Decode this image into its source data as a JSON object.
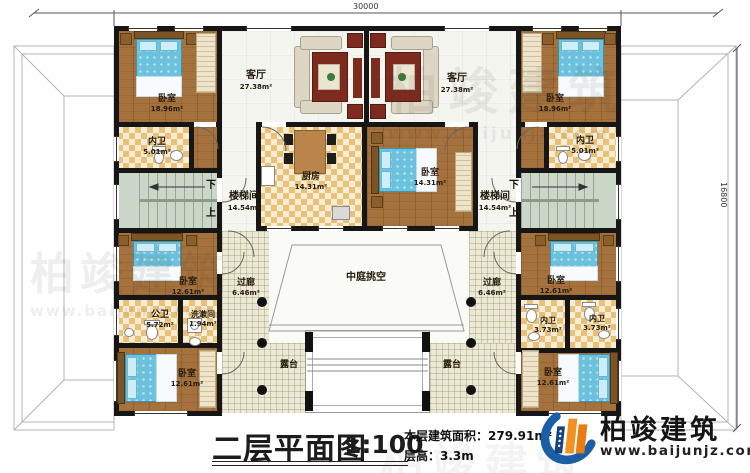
{
  "dimensions": {
    "top": "30000",
    "right": "16800"
  },
  "rooms": {
    "living_left": {
      "name": "客厅",
      "area": "27.38m²"
    },
    "living_right": {
      "name": "客厅",
      "area": "27.38m²"
    },
    "bedroom_tl": {
      "name": "卧室",
      "area": "18.96m²"
    },
    "bedroom_tr": {
      "name": "卧室",
      "area": "18.96m²"
    },
    "bath_tl": {
      "name": "内卫",
      "area": "5.01m²"
    },
    "bath_tr": {
      "name": "内卫",
      "area": "5.01m²"
    },
    "kitchen": {
      "name": "厨房",
      "area": "14.31m²"
    },
    "bedroom_center": {
      "name": "卧室",
      "area": "14.31m²"
    },
    "stair_left": {
      "name": "楼梯间",
      "area": "14.54m²"
    },
    "stair_right": {
      "name": "楼梯间",
      "area": "14.54m²"
    },
    "bedroom_ml": {
      "name": "卧室",
      "area": "12.61m²"
    },
    "bedroom_mr": {
      "name": "卧室",
      "area": "12.61m²"
    },
    "public_bath": {
      "name": "公卫",
      "area": "5.72m²"
    },
    "wash_room": {
      "name": "洗漱间",
      "area": "1.94m²"
    },
    "bath_br1": {
      "name": "内卫",
      "area": "3.73m²"
    },
    "bath_br2": {
      "name": "内卫",
      "area": "3.73m²"
    },
    "corridor_left": {
      "name": "过廊",
      "area": "6.46m²"
    },
    "corridor_right": {
      "name": "过廊",
      "area": "6.46m²"
    },
    "atrium": {
      "name": "中庭挑空"
    },
    "terrace_left": {
      "name": "露台"
    },
    "terrace_right": {
      "name": "露台"
    },
    "bedroom_bl": {
      "name": "卧室",
      "area": "12.61m²"
    },
    "bedroom_br": {
      "name": "卧室",
      "area": "12.61m²"
    }
  },
  "stairs": {
    "down": "下",
    "up": "上"
  },
  "title_block": {
    "title": "二层平面图",
    "scale": "1:100",
    "area_label": "本层建筑面积：",
    "area_value": "279.91m²",
    "floor_height_label": "层高：",
    "floor_height_value": "3.3m"
  },
  "brand": {
    "name": "柏竣建筑",
    "website": "www.baijunjz.com"
  },
  "watermark": {
    "name": "柏竣建筑",
    "website": "www.baijunjz.com"
  },
  "colors": {
    "wall": "#161616",
    "wood": "#a5713c",
    "tile": "#e8c078",
    "stair": "#ccd6c8",
    "bed": "#6cc2dc",
    "brand_blue": "#1b5ea8",
    "brand_orange": "#f2921e"
  }
}
